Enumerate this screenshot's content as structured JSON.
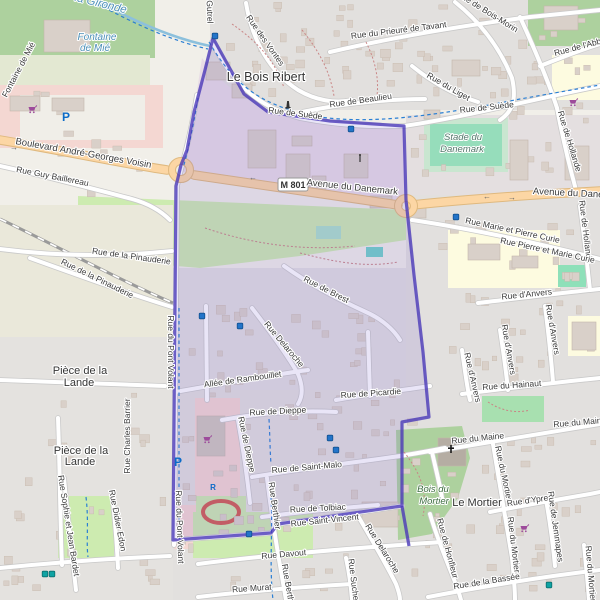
{
  "map": {
    "shield": {
      "text": "M 801"
    },
    "colors": {
      "boundary": "#4a38b8",
      "boundary_fill": "rgba(123,102,210,0.17)",
      "primary_road": "#fcd6a4",
      "water": "#8cc0dc",
      "forest": "#add19e",
      "grass": "#cdebb0",
      "industrial": "#e8dce6",
      "retail": "#f4d7d2",
      "residential": "#e2e0de",
      "school": "#fdfbe0",
      "building": "#d9d0c9",
      "poi_purple": "#9d4b9b",
      "poi_blue": "#0b6bc8",
      "bus_blue": "#2374c9",
      "tram_teal": "#0fa3a3"
    },
    "labels": [
      {
        "text": "la Gironde",
        "x": 100,
        "y": 7,
        "r": 14,
        "cls": "w wl"
      },
      {
        "text": "Fontaine",
        "x": 97,
        "y": 40,
        "r": 0,
        "cls": "w"
      },
      {
        "text": "de Mié",
        "x": 95,
        "y": 51,
        "r": 0,
        "cls": "w"
      },
      {
        "text": "Fontaine de Mié",
        "x": 21,
        "y": 71,
        "r": -62,
        "cls": ""
      },
      {
        "text": "Gutrel",
        "x": 207,
        "y": 12,
        "r": 88,
        "cls": ""
      },
      {
        "text": "Rue des Vontes",
        "x": 263,
        "y": 42,
        "r": 55,
        "cls": ""
      },
      {
        "text": "Rue du Prieuré de Tavant",
        "x": 399,
        "y": 33,
        "r": -7,
        "cls": ""
      },
      {
        "text": "Rue de Bois-Morin",
        "x": 486,
        "y": 14,
        "r": 32,
        "cls": ""
      },
      {
        "text": "Rue du Liget",
        "x": 447,
        "y": 89,
        "r": 30,
        "cls": ""
      },
      {
        "text": "Rue de l'Abbaye",
        "x": 585,
        "y": 48,
        "r": -15,
        "cls": ""
      },
      {
        "text": "Rue de Beaulieu",
        "x": 361,
        "y": 103,
        "r": -8,
        "cls": ""
      },
      {
        "text": "Le Bois Ribert",
        "x": 266,
        "y": 81,
        "r": 0,
        "cls": "p"
      },
      {
        "text": "Rue de Suède",
        "x": 295,
        "y": 116,
        "r": 7,
        "cls": ""
      },
      {
        "text": "Rue de Suède",
        "x": 487,
        "y": 110,
        "r": -6,
        "cls": ""
      },
      {
        "text": "Avenue du Danemark",
        "x": 352,
        "y": 190,
        "r": 6,
        "cls": "r9"
      },
      {
        "text": "Avenue du Danem",
        "x": 572,
        "y": 196,
        "r": 3,
        "cls": "r9"
      },
      {
        "text": "Boulevard André-Georges Voisin",
        "x": 83,
        "y": 156,
        "r": 10,
        "cls": "r9"
      },
      {
        "text": "Rue Guy Baillereau",
        "x": 52,
        "y": 179,
        "r": 11,
        "cls": ""
      },
      {
        "text": "Stade du",
        "x": 463,
        "y": 140,
        "r": 0,
        "cls": "s"
      },
      {
        "text": "Danemark",
        "x": 462,
        "y": 152,
        "r": 0,
        "cls": "s"
      },
      {
        "text": "Rue de Hollande",
        "x": 567,
        "y": 142,
        "r": 73,
        "cls": ""
      },
      {
        "text": "Rue de Hollande",
        "x": 583,
        "y": 232,
        "r": 83,
        "cls": ""
      },
      {
        "text": "Rue Marie et Pierre Curie",
        "x": 512,
        "y": 233,
        "r": 12,
        "cls": ""
      },
      {
        "text": "Rue Pierre et Marie Curie",
        "x": 547,
        "y": 253,
        "r": 12,
        "cls": ""
      },
      {
        "text": "Rue d'Anvers",
        "x": 527,
        "y": 297,
        "r": -6,
        "cls": ""
      },
      {
        "text": "Rue d'Anvers",
        "x": 550,
        "y": 330,
        "r": 80,
        "cls": ""
      },
      {
        "text": "Rue d'Anvers",
        "x": 506,
        "y": 350,
        "r": 80,
        "cls": ""
      },
      {
        "text": "Rue d'Anvers",
        "x": 470,
        "y": 378,
        "r": 77,
        "cls": ""
      },
      {
        "text": "Rue du Hainaut",
        "x": 512,
        "y": 388,
        "r": -4,
        "cls": ""
      },
      {
        "text": "Rue de la Pinauderie",
        "x": 131,
        "y": 259,
        "r": 8,
        "cls": ""
      },
      {
        "text": "Rue de la Pinauderie",
        "x": 96,
        "y": 281,
        "r": 26,
        "cls": ""
      },
      {
        "text": "Pièce de la",
        "x": 80,
        "y": 374,
        "r": 0,
        "cls": "p p2"
      },
      {
        "text": "Lande",
        "x": 79,
        "y": 386,
        "r": 0,
        "cls": "p p2"
      },
      {
        "text": "Pièce de la",
        "x": 81,
        "y": 454,
        "r": 0,
        "cls": "p p2"
      },
      {
        "text": "Lande",
        "x": 80,
        "y": 465,
        "r": 0,
        "cls": "p p2"
      },
      {
        "text": "Rue Charles Barrier",
        "x": 130,
        "y": 436,
        "r": -90,
        "cls": ""
      },
      {
        "text": "Rue Sophie et Jean Bardet",
        "x": 66,
        "y": 526,
        "r": 81,
        "cls": ""
      },
      {
        "text": "Rue Didier Edon",
        "x": 115,
        "y": 521,
        "r": 79,
        "cls": ""
      },
      {
        "text": "Rue du Pont Volant",
        "x": 168,
        "y": 352,
        "r": 90,
        "cls": ""
      },
      {
        "text": "Rue du Pont Volant",
        "x": 177,
        "y": 527,
        "r": 88,
        "cls": ""
      },
      {
        "text": "Rue Delaroche",
        "x": 282,
        "y": 346,
        "r": 50,
        "cls": ""
      },
      {
        "text": "Rue de Brest",
        "x": 325,
        "y": 292,
        "r": 27,
        "cls": ""
      },
      {
        "text": "Allée de Rambouillet",
        "x": 243,
        "y": 382,
        "r": -8,
        "cls": ""
      },
      {
        "text": "Rue de Picardie",
        "x": 371,
        "y": 396,
        "r": -4,
        "cls": ""
      },
      {
        "text": "Rue de Dieppe",
        "x": 278,
        "y": 414,
        "r": -3,
        "cls": ""
      },
      {
        "text": "Rue de Dieppe",
        "x": 244,
        "y": 445,
        "r": 78,
        "cls": ""
      },
      {
        "text": "Rue de Saint-Malo",
        "x": 307,
        "y": 470,
        "r": -5,
        "cls": ""
      },
      {
        "text": "Rue de Tolbiac",
        "x": 318,
        "y": 511,
        "r": -3,
        "cls": ""
      },
      {
        "text": "Rue Saint-Vincent",
        "x": 325,
        "y": 523,
        "r": -6,
        "cls": ""
      },
      {
        "text": "Rue Davout",
        "x": 284,
        "y": 557,
        "r": -5,
        "cls": ""
      },
      {
        "text": "Rue Murat",
        "x": 252,
        "y": 591,
        "r": -4,
        "cls": ""
      },
      {
        "text": "Rue Berthier",
        "x": 272,
        "y": 506,
        "r": 82,
        "cls": ""
      },
      {
        "text": "Rue Berthier",
        "x": 286,
        "y": 588,
        "r": 80,
        "cls": ""
      },
      {
        "text": "Rue Suchet",
        "x": 351,
        "y": 581,
        "r": 83,
        "cls": ""
      },
      {
        "text": "Rue Delaroche",
        "x": 380,
        "y": 550,
        "r": 58,
        "cls": ""
      },
      {
        "text": "Rue du Maine",
        "x": 478,
        "y": 441,
        "r": -6,
        "cls": ""
      },
      {
        "text": "Rue du Maine",
        "x": 580,
        "y": 425,
        "r": -5,
        "cls": ""
      },
      {
        "text": "Rue du Mortier",
        "x": 501,
        "y": 474,
        "r": 78,
        "cls": ""
      },
      {
        "text": "Rue du Mortier",
        "x": 511,
        "y": 545,
        "r": 83,
        "cls": ""
      },
      {
        "text": "Rue du Mortier",
        "x": 588,
        "y": 574,
        "r": 85,
        "cls": ""
      },
      {
        "text": "Rue d'Ypres",
        "x": 530,
        "y": 503,
        "r": -8,
        "cls": ""
      },
      {
        "text": "Rue de Jemmapes",
        "x": 553,
        "y": 527,
        "r": 82,
        "cls": ""
      },
      {
        "text": "Le Mortier",
        "x": 477,
        "y": 506,
        "r": 0,
        "cls": "p p2"
      },
      {
        "text": "Bois du",
        "x": 433,
        "y": 492,
        "r": 0,
        "cls": "f"
      },
      {
        "text": "Mortier",
        "x": 434,
        "y": 504,
        "r": 0,
        "cls": "f"
      },
      {
        "text": "Rue de Honfleur",
        "x": 445,
        "y": 549,
        "r": 75,
        "cls": ""
      },
      {
        "text": "Rue de la Bassée",
        "x": 487,
        "y": 584,
        "r": -9,
        "cls": ""
      }
    ],
    "icons": [
      {
        "t": "supermarket",
        "x": 32,
        "y": 110
      },
      {
        "t": "supermarket",
        "x": 573,
        "y": 103
      },
      {
        "t": "supermarket",
        "x": 207,
        "y": 440
      },
      {
        "t": "supermarket",
        "x": 524,
        "y": 529
      },
      {
        "t": "parking",
        "x": 66,
        "y": 117
      },
      {
        "t": "parking",
        "x": 178,
        "y": 462
      },
      {
        "t": "parking-r",
        "x": 213,
        "y": 486
      },
      {
        "t": "bus",
        "x": 215,
        "y": 36
      },
      {
        "t": "bus",
        "x": 351,
        "y": 129
      },
      {
        "t": "bus",
        "x": 456,
        "y": 217
      },
      {
        "t": "bus",
        "x": 202,
        "y": 316
      },
      {
        "t": "bus",
        "x": 240,
        "y": 326
      },
      {
        "t": "bus",
        "x": 330,
        "y": 438
      },
      {
        "t": "bus",
        "x": 336,
        "y": 450
      },
      {
        "t": "bus",
        "x": 249,
        "y": 534
      },
      {
        "t": "tram",
        "x": 45,
        "y": 574
      },
      {
        "t": "tram",
        "x": 52,
        "y": 574
      },
      {
        "t": "tram",
        "x": 549,
        "y": 585
      },
      {
        "t": "monument",
        "x": 288,
        "y": 106
      },
      {
        "t": "mast",
        "x": 360,
        "y": 160
      },
      {
        "t": "church",
        "x": 451,
        "y": 450
      },
      {
        "t": "arrow",
        "x": 14,
        "y": 147,
        "g": "→"
      },
      {
        "t": "arrow",
        "x": 101,
        "y": 158,
        "g": "←"
      },
      {
        "t": "arrow",
        "x": 253,
        "y": 177,
        "g": "←"
      },
      {
        "t": "arrow",
        "x": 487,
        "y": 196,
        "g": "←"
      },
      {
        "t": "arrow",
        "x": 512,
        "y": 197,
        "g": "→"
      }
    ]
  }
}
